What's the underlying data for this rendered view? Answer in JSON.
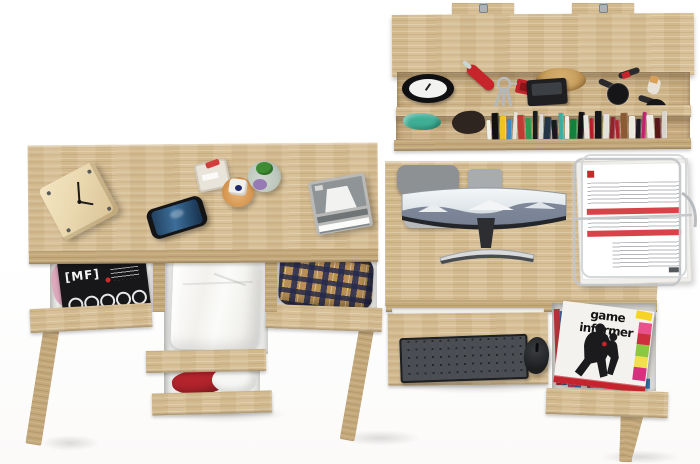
{
  "meta": {
    "type": "furniture product photo",
    "subject": "Top-down view of a two-desk oak home-office set with open drawers and a wall shelf",
    "background_color": "#ffffff",
    "wood_color": "#d6bd92",
    "wood_dark_color": "#c3a87a"
  },
  "left_desk": {
    "label": "left desk",
    "desktop_items": [
      {
        "label": "wooden cube clock",
        "color": "#ead8b0",
        "hands_color": "#1a1a1a"
      },
      {
        "label": "smartphone",
        "body_color": "#141416",
        "screen_color": "#2e5579"
      },
      {
        "label": "square glass perfume bottle",
        "accent_color": "#d23c3c"
      },
      {
        "label": "amber round perfume bottle",
        "accent_color": "#d89a55",
        "gem_color": "#1d2a6b"
      },
      {
        "label": "green round perfume bottle",
        "accent_color": "#3d8c33",
        "glass_color": "#8d6bb0"
      },
      {
        "label": "grey letter tray stack",
        "color": "#9fa3a4"
      }
    ],
    "drawers": [
      {
        "position": "left",
        "contents": "music magazines",
        "magazine_title": "[MF]",
        "cover_color": "#17171a",
        "cloth_accent": "#dfa8bc"
      },
      {
        "position": "middle-top",
        "contents": "folded white shirt",
        "color": "#fafaf8"
      },
      {
        "position": "right",
        "contents": "plaid shirt",
        "colors": [
          "#b98f53",
          "#2a3055",
          "#e9e2d2"
        ]
      },
      {
        "position": "middle-bottom",
        "contents": "red and white clothing",
        "colors": [
          "#b3242c",
          "#f6f6f4"
        ]
      }
    ]
  },
  "wall_shelf": {
    "label": "wall-mounted shelf above right desk",
    "mount_tabs": 2,
    "upper_items": [
      {
        "label": "alarm clock",
        "colors": [
          "#101012",
          "#f2f2f0"
        ]
      },
      {
        "label": "red pocket knife",
        "color": "#c5252b"
      },
      {
        "label": "bunch of keys",
        "fob_color": "#c0242b"
      },
      {
        "label": "straw hat",
        "color": "#c9a05e"
      },
      {
        "label": "black compact camera",
        "color": "#1f1f22"
      },
      {
        "label": "makeup brush set",
        "color": "#161618"
      },
      {
        "label": "makeup brush set",
        "color": "#161618"
      }
    ],
    "lower_items": [
      {
        "label": "teal crumpled cloth",
        "color": "#3fae96"
      },
      {
        "label": "dark pouch",
        "color": "#2e2420"
      }
    ],
    "books": {
      "count": 28,
      "spine_colors": [
        "#f2efe8",
        "#111111",
        "#f0c41f",
        "#3f87c0",
        "#e5e2da",
        "#c23b33",
        "#2c9a55",
        "#1c1c1e",
        "#dcd8cf",
        "#243447",
        "#19191b",
        "#3bb0a0",
        "#efece4",
        "#15803c",
        "#121214",
        "#e8e5de",
        "#b32028",
        "#16161a",
        "#e4e1d9",
        "#8f2430",
        "#a9252e",
        "#8a5a33",
        "#ece9e1",
        "#1a1a1c",
        "#c5206e",
        "#efece5",
        "#59161c",
        "#d8d4cb"
      ]
    }
  },
  "right_desk": {
    "label": "right desk with keyboard tray",
    "chair": {
      "label": "grey office chair",
      "backrest_color": "#8e9194",
      "seat_color": "#b7babc"
    },
    "monitor": {
      "label": "curved ultrawide monitor",
      "screen_theme": "snowy mountain wallpaper",
      "bezel_color": "#23252a"
    },
    "document_tray": {
      "label": "wire document tray with invoices",
      "paper_color": "#ffffff",
      "accent_color": "#d8434a"
    },
    "keyboard": {
      "label": "dark desktop keyboard",
      "color": "#35373a"
    },
    "mouse": {
      "label": "black wireless mouse",
      "color": "#1c1d1f"
    },
    "drawer": {
      "contents": "video game magazines",
      "magazine_title": "game informer",
      "cover_color": "#f4f2ee",
      "tag_color": "#f5d327",
      "bottom_bar_color": "#c4242e",
      "side_banner_colors": [
        "#e9518d",
        "#cf2e3e",
        "#8dc63f",
        "#f0e04a",
        "#d5317f"
      ]
    }
  }
}
